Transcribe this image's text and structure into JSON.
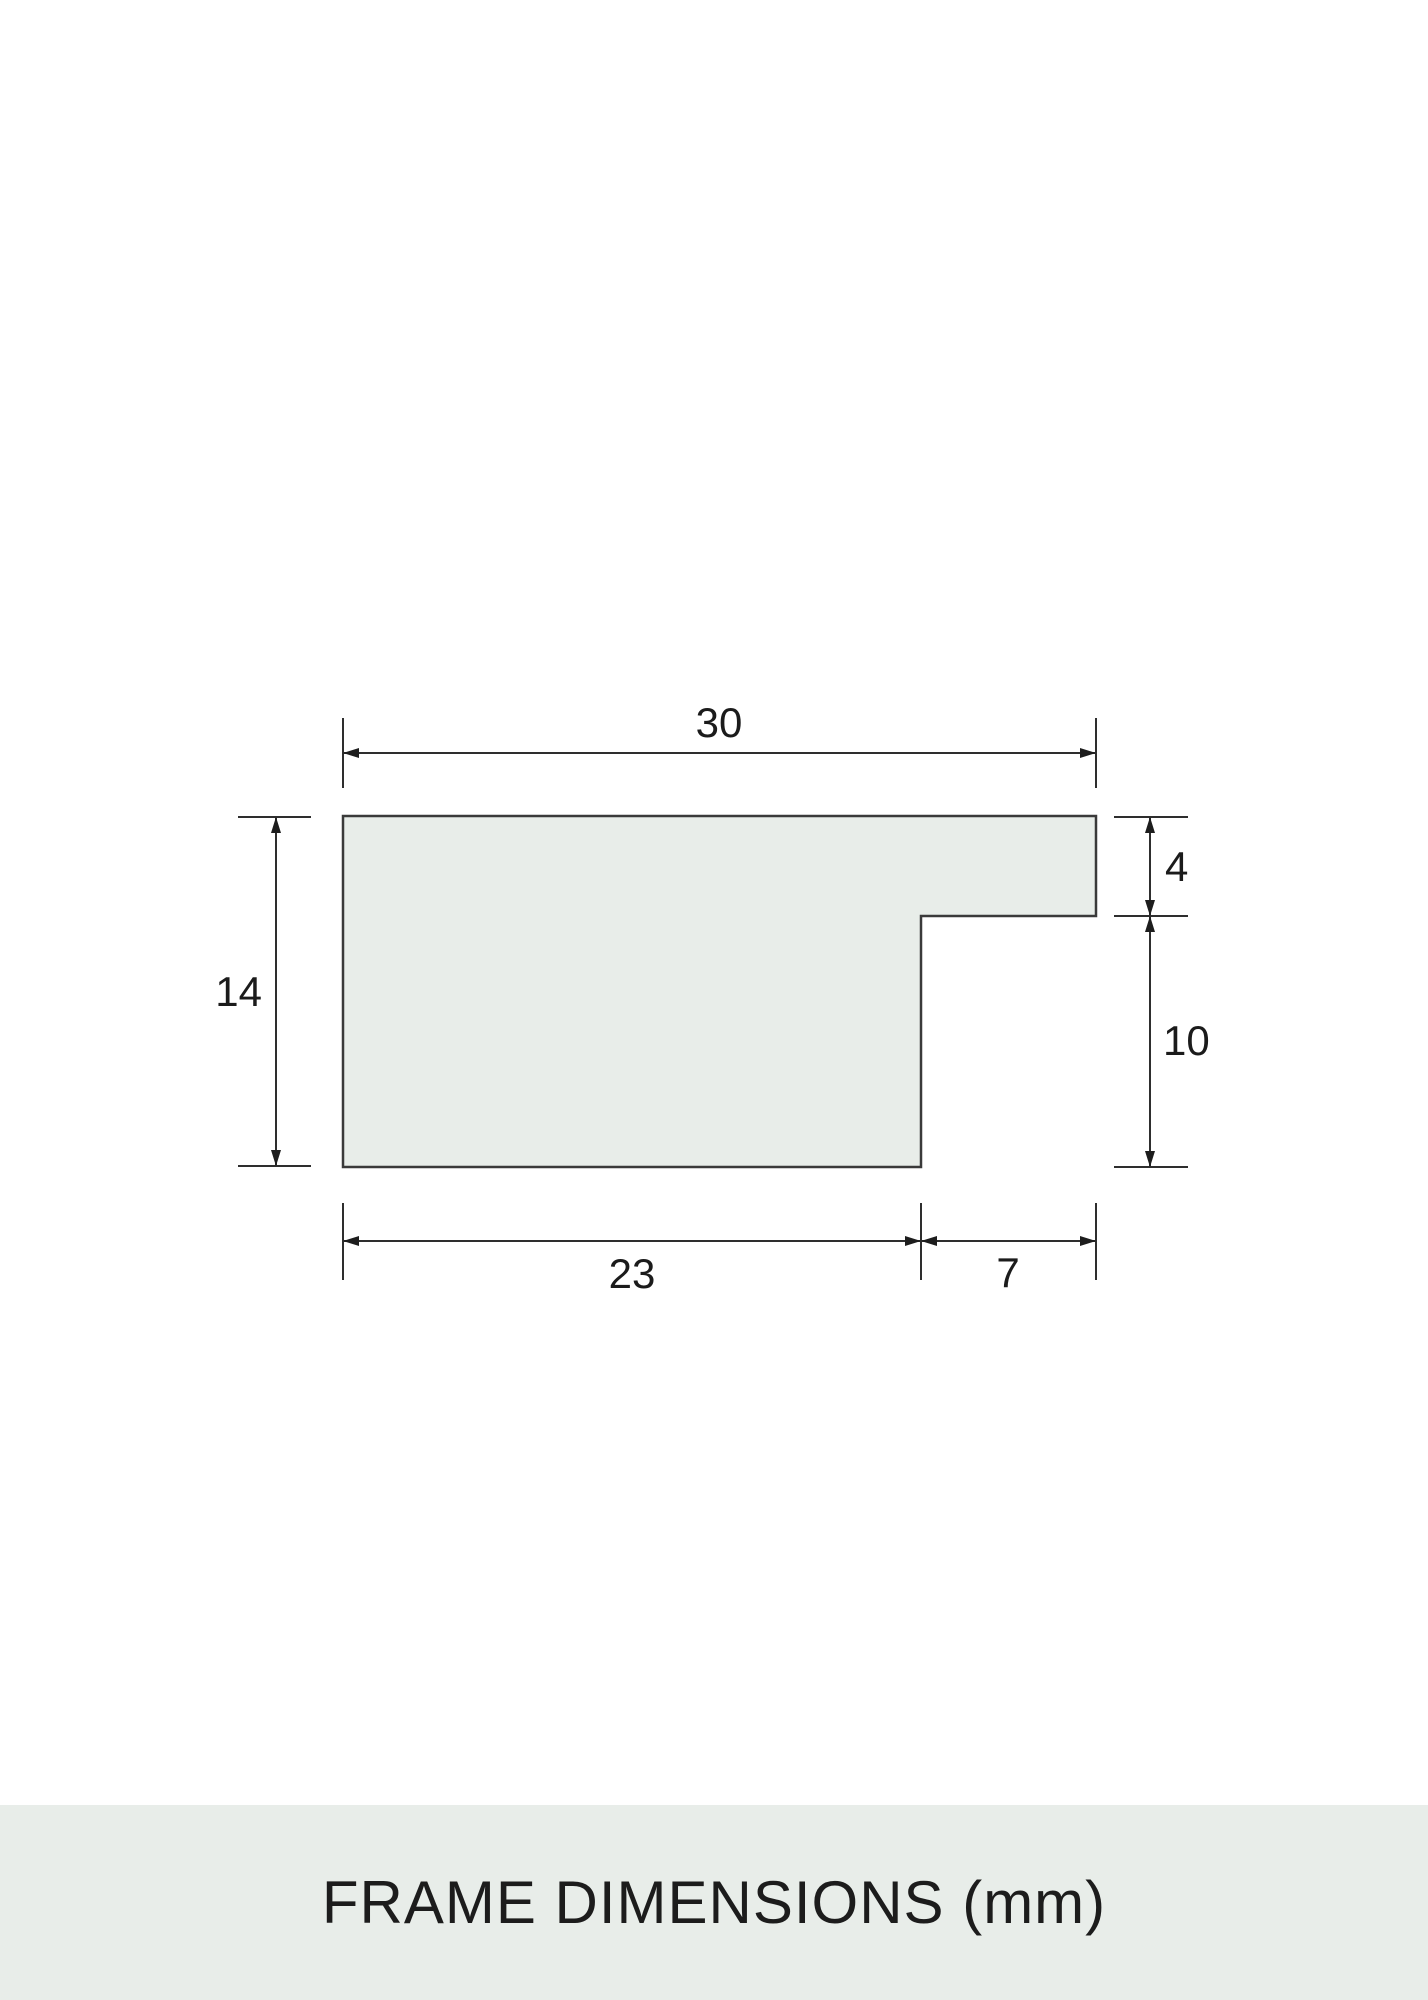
{
  "title": {
    "text": "FRAME DIMENSIONS (mm)"
  },
  "profile": {
    "unit": "mm",
    "dims": {
      "overall_width": "30",
      "overall_height": "14",
      "lip_depth": "4",
      "rabbet_height": "10",
      "body_width": "23",
      "lip_width": "7"
    }
  },
  "colors": {
    "background": "#ffffff",
    "band": "#e8ede9",
    "shape_fill": "#e8ede9",
    "line": "#2e2e2e",
    "outline": "#3a3a3a",
    "text": "#1b1b1b"
  }
}
